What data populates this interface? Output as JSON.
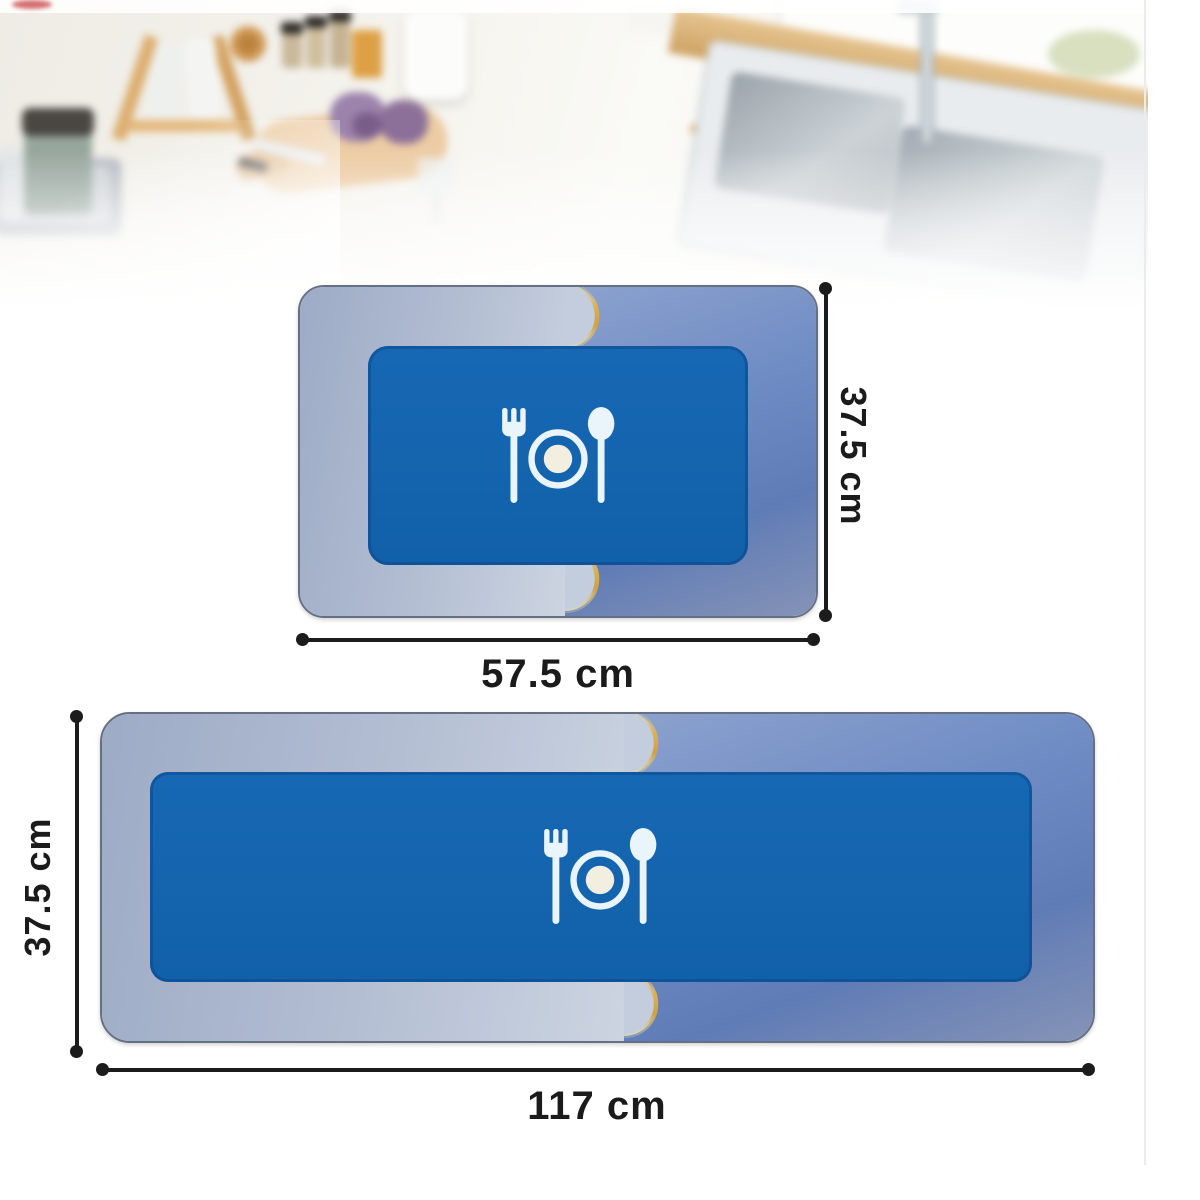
{
  "scene": {
    "description": "Blurry bright kitchen countertop photo backdrop",
    "items": [
      "dish-tray",
      "drinking-glass",
      "canister",
      "bottle-rack",
      "bottles",
      "wooden-jar",
      "spice-jars",
      "amber-jar",
      "cutting-board",
      "purple-vegetables",
      "knife",
      "white-pitcher",
      "wine-glass",
      "small-bowls",
      "paper-towel-holder",
      "wooden-plank",
      "wall-panel",
      "double-sink",
      "faucet",
      "plant"
    ]
  },
  "mats": {
    "small": {
      "width_label": "57.5 cm",
      "height_label": "37.5 cm"
    },
    "long": {
      "width_label": "117 cm",
      "height_label": "37.5 cm"
    },
    "icon": "fork-plate-spoon-icon",
    "colors": {
      "left_half": "#a9b6ce",
      "right_half": "#6787c0",
      "inner_panel": "#1565b0",
      "seam_gold": "#d4a94c",
      "icon_color": "#e9f4fb",
      "plate_center": "#f2efe0"
    }
  },
  "annotation": {
    "line_color": "#1c1c1c",
    "text_color": "#1b1b1b"
  }
}
